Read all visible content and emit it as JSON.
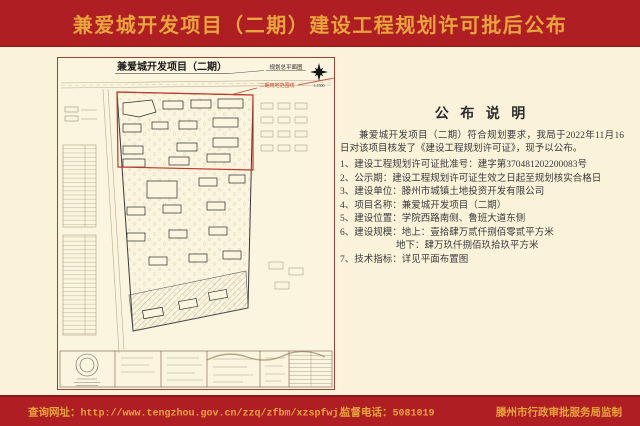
{
  "page": {
    "title": "兼爱城开发项目（二期）建设工程规划许可批后公布"
  },
  "plan": {
    "title": "兼爱城开发项目（二期）",
    "subtitle": "规划总平面图",
    "scale": "1:1500",
    "boundary_label": "二期用地范围线"
  },
  "notice": {
    "heading": "公 布 说 明",
    "intro": "兼爱城开发项目（二期）符合规划要求，我局于2022年11月16日对该项目核发了《建设工程规划许可证》，现予以公布。",
    "lines": [
      "1、建设工程规划许可证批准号：建字第370481202200083号",
      "2、公示期：建设工程规划许可证生效之日起至规划核实合格日",
      "3、建设单位：滕州市城镇土地投资开发有限公司",
      "4、项目名称：兼爱城开发项目（二期）",
      "5、建设位置：学院西路南侧、鲁班大道东侧",
      "6、建设规模：地上：壹拾肆万贰仟捌佰零贰平方米",
      "地下：肆万玖仟捌佰玖拾玖平方米",
      "7、技术指标：详见平面布置图"
    ]
  },
  "footer": {
    "website_label": "查询网址：",
    "website_url": "http://www.tengzhou.gov.cn/zzq/zfbm/xzspfwj/",
    "phone_label": "监督电话：",
    "phone": "5081019",
    "producer": "滕州市行政审批服务局监制"
  },
  "colors": {
    "page_red": "#AE1E22",
    "deep_red": "#8E1719",
    "gold": "#E9A43C",
    "paper": "#FAF3DA",
    "ink": "#3A3A3A",
    "boundary_red": "#C0392B",
    "frame_maroon": "#9C4038"
  }
}
